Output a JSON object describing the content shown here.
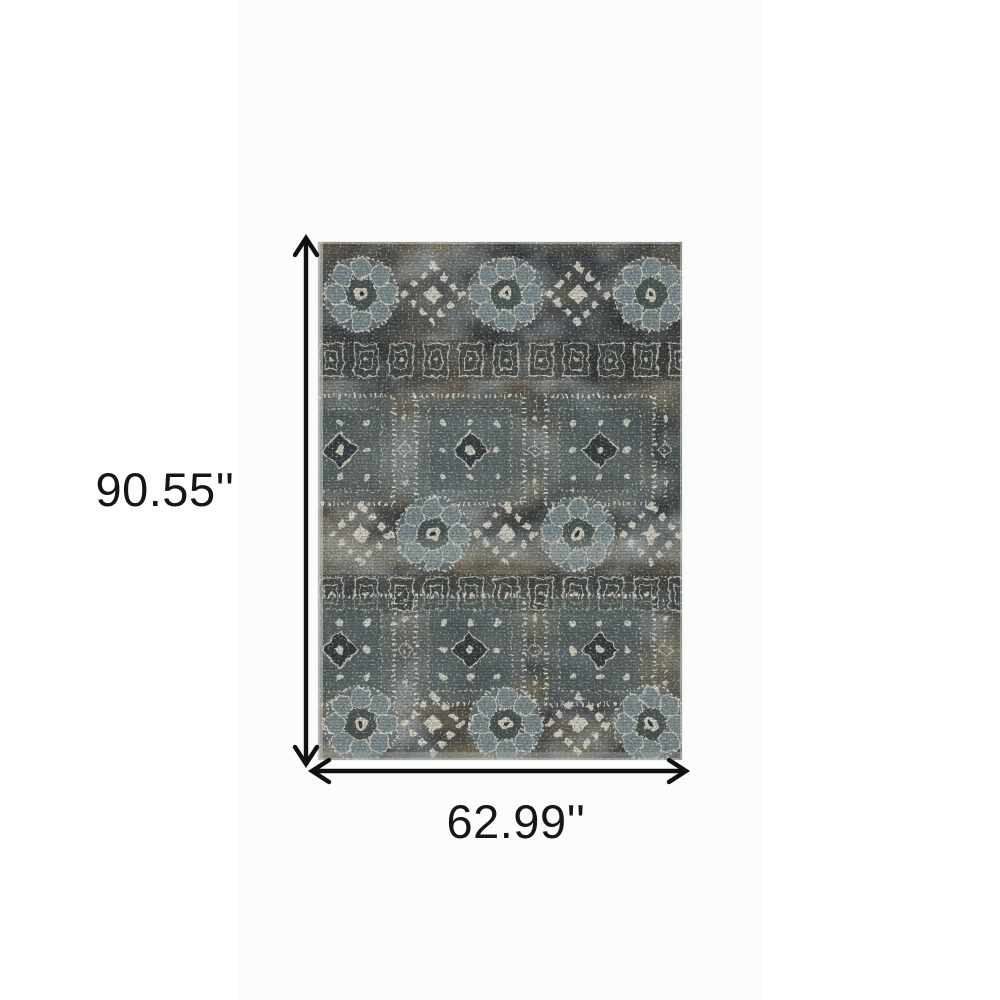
{
  "image": {
    "subject": "Distressed vintage oriental area rug, top view, gray blue and brown tones"
  },
  "dimensions": {
    "height_label": "90.55''",
    "width_label": "62.99''"
  },
  "style": {
    "arrow_color": "#111111",
    "label_color": "#161616",
    "page_background": "#ffffff",
    "backdrop": "#fcfcfc",
    "rug_charcoal": "#2b2f31",
    "rug_slate": "#5f7077",
    "rug_light_slate": "#94a4a6",
    "rug_brown": "#56401f",
    "rug_cream": "#d7d3c3"
  }
}
